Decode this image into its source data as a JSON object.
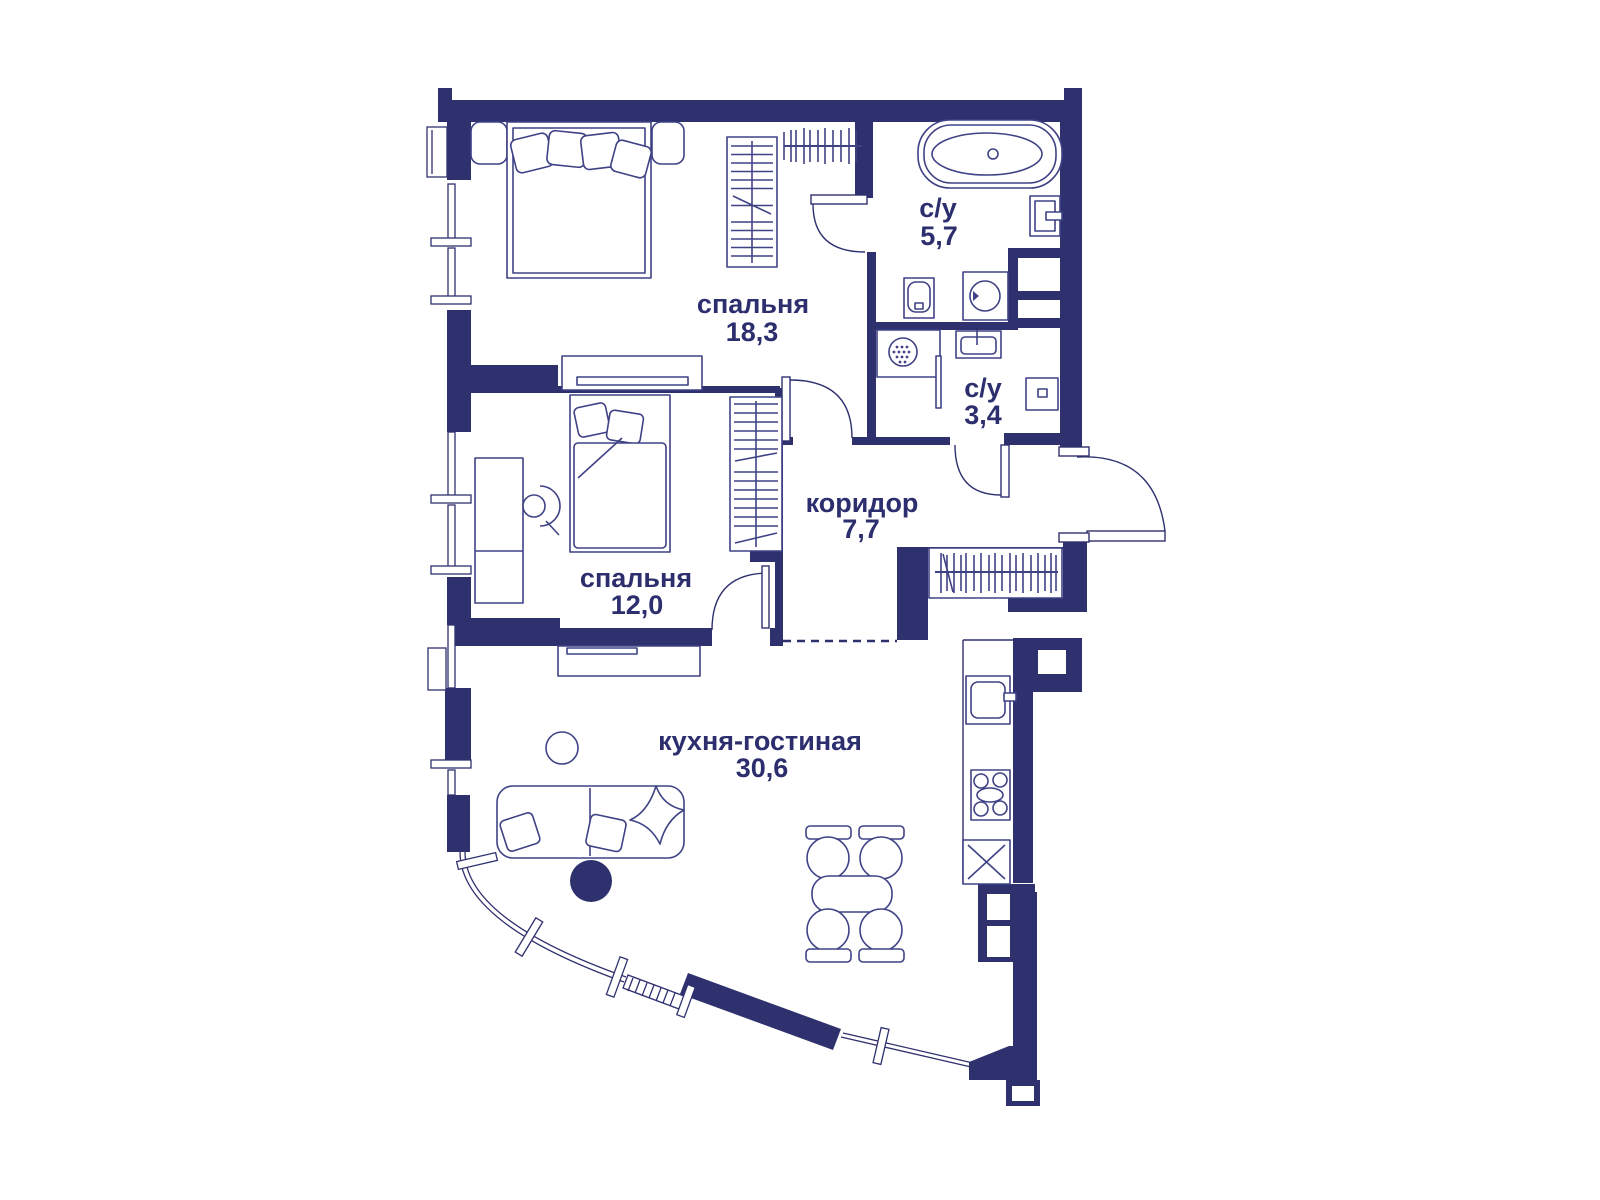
{
  "plan_type": "apartment-floor-plan",
  "colors": {
    "wall": "#2f316e",
    "furniture": "#3f4285",
    "text": "#2c2e6e",
    "background": "#ffffff"
  },
  "rooms": [
    {
      "id": "bedroom-large",
      "name": "спальня",
      "area": "18,3"
    },
    {
      "id": "bathroom-large",
      "name": "с/у",
      "area": "5,7"
    },
    {
      "id": "bathroom-small",
      "name": "с/у",
      "area": "3,4"
    },
    {
      "id": "bedroom-small",
      "name": "спальня",
      "area": "12,0"
    },
    {
      "id": "corridor",
      "name": "коридор",
      "area": "7,7"
    },
    {
      "id": "kitchen-living",
      "name": "кухня-гостиная",
      "area": "30,6"
    }
  ],
  "symbols": [
    "double-bed",
    "bedside-table",
    "wardrobe",
    "hanger-rod",
    "bathtub",
    "sink",
    "toilet",
    "washing-machine",
    "shower",
    "tv-console",
    "single-bed",
    "desk",
    "desk-chair",
    "sofa",
    "pillow",
    "round-table",
    "pouf",
    "dining-table",
    "dining-chair",
    "kitchen-sink",
    "stove",
    "hood-appliance",
    "entrance-door",
    "interior-door",
    "window",
    "curved-glazing",
    "duct-shaft"
  ]
}
